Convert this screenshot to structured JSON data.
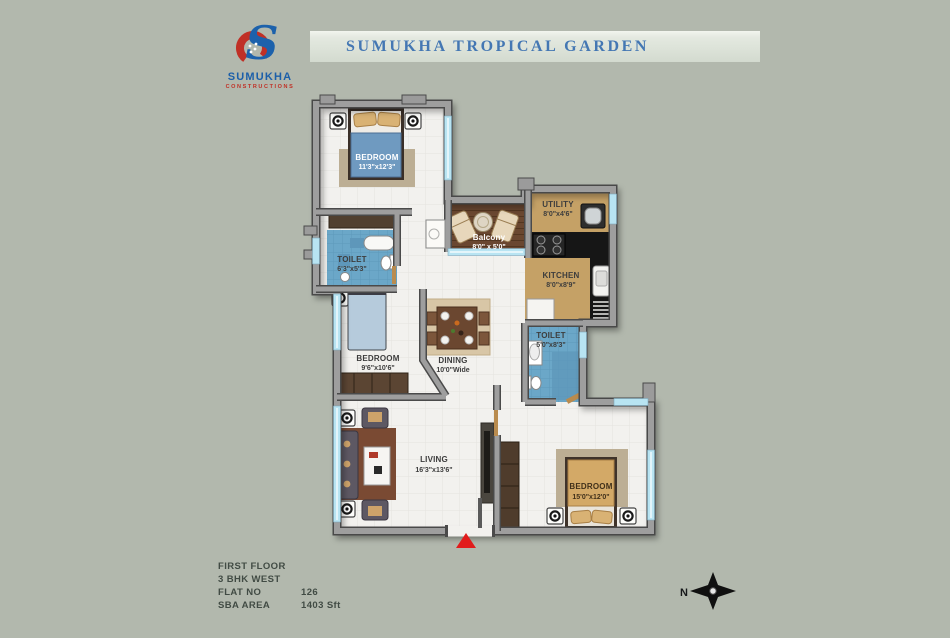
{
  "header": {
    "banner_title": "SUMUKHA TROPICAL GARDEN",
    "logo": {
      "monogram": "S",
      "name": "SUMUKHA",
      "subtitle": "CONSTRUCTIONS"
    }
  },
  "plan": {
    "rooms": {
      "bedroom1": {
        "name": "BEDROOM",
        "dims": "11'3\"x12'3\""
      },
      "toilet1": {
        "name": "TOILET",
        "dims": "6'3\"x5'3\""
      },
      "bedroom2": {
        "name": "BEDROOM",
        "dims": "9'6\"x10'6\""
      },
      "balcony": {
        "name": "Balcony",
        "dims": "8'0\" x 5'0\""
      },
      "utility": {
        "name": "UTILITY",
        "dims": "8'0\"x4'6\""
      },
      "kitchen": {
        "name": "KITCHEN",
        "dims": "8'0\"x8'9\""
      },
      "toilet2": {
        "name": "TOILET",
        "dims": "5'0\"x8'3\""
      },
      "dining": {
        "name": "DINING",
        "dims": "10'0\"Wide"
      },
      "living": {
        "name": "LIVING",
        "dims": "16'3\"x13'6\""
      },
      "bedroom3": {
        "name": "BEDROOM",
        "dims": "15'0\"x12'0\""
      }
    }
  },
  "info": {
    "floor": "FIRST FLOOR",
    "type": "3 BHK WEST",
    "flat_label": "FLAT NO",
    "flat_value": "126",
    "sba_label": "SBA  AREA",
    "sba_value": "1403 Sft"
  },
  "compass": {
    "north_label": "N"
  },
  "colors": {
    "background": "#b2b8ad",
    "banner_text": "#4477b3",
    "logo_blue": "#1c5fa9",
    "logo_red": "#c03026",
    "wall": "#9e9e9e",
    "floor": "#f2f1ee",
    "toilet_floor": "#6ba7c8",
    "balcony_floor": "#6a4730",
    "kitchen_floor": "#c5a166",
    "window": "#b8e4f2",
    "entrance_marker": "#e11c1c"
  }
}
